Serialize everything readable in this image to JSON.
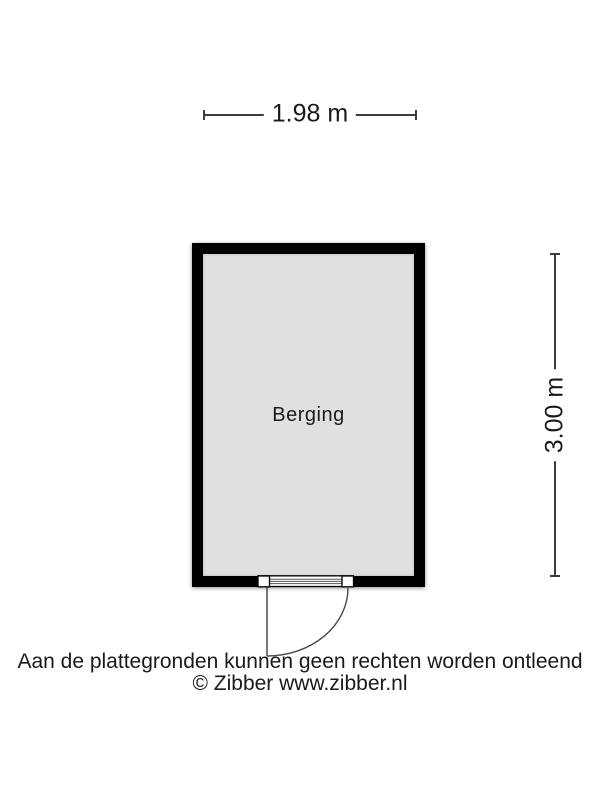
{
  "floorplan": {
    "room": {
      "label": "Berging",
      "width_label": "1.98 m",
      "depth_label": "3.00 m"
    },
    "footer": {
      "disclaimer": "Aan de plattegronden kunnen geen rechten worden ontleend",
      "copyright": "© Zibber www.zibber.nl"
    },
    "colors": {
      "wall": "#000000",
      "floor": "#e0e0e0",
      "dimension_line": "#3c3c3c",
      "door_line": "#4a4a4a",
      "background": "#ffffff",
      "text": "#1a1a1a"
    }
  }
}
